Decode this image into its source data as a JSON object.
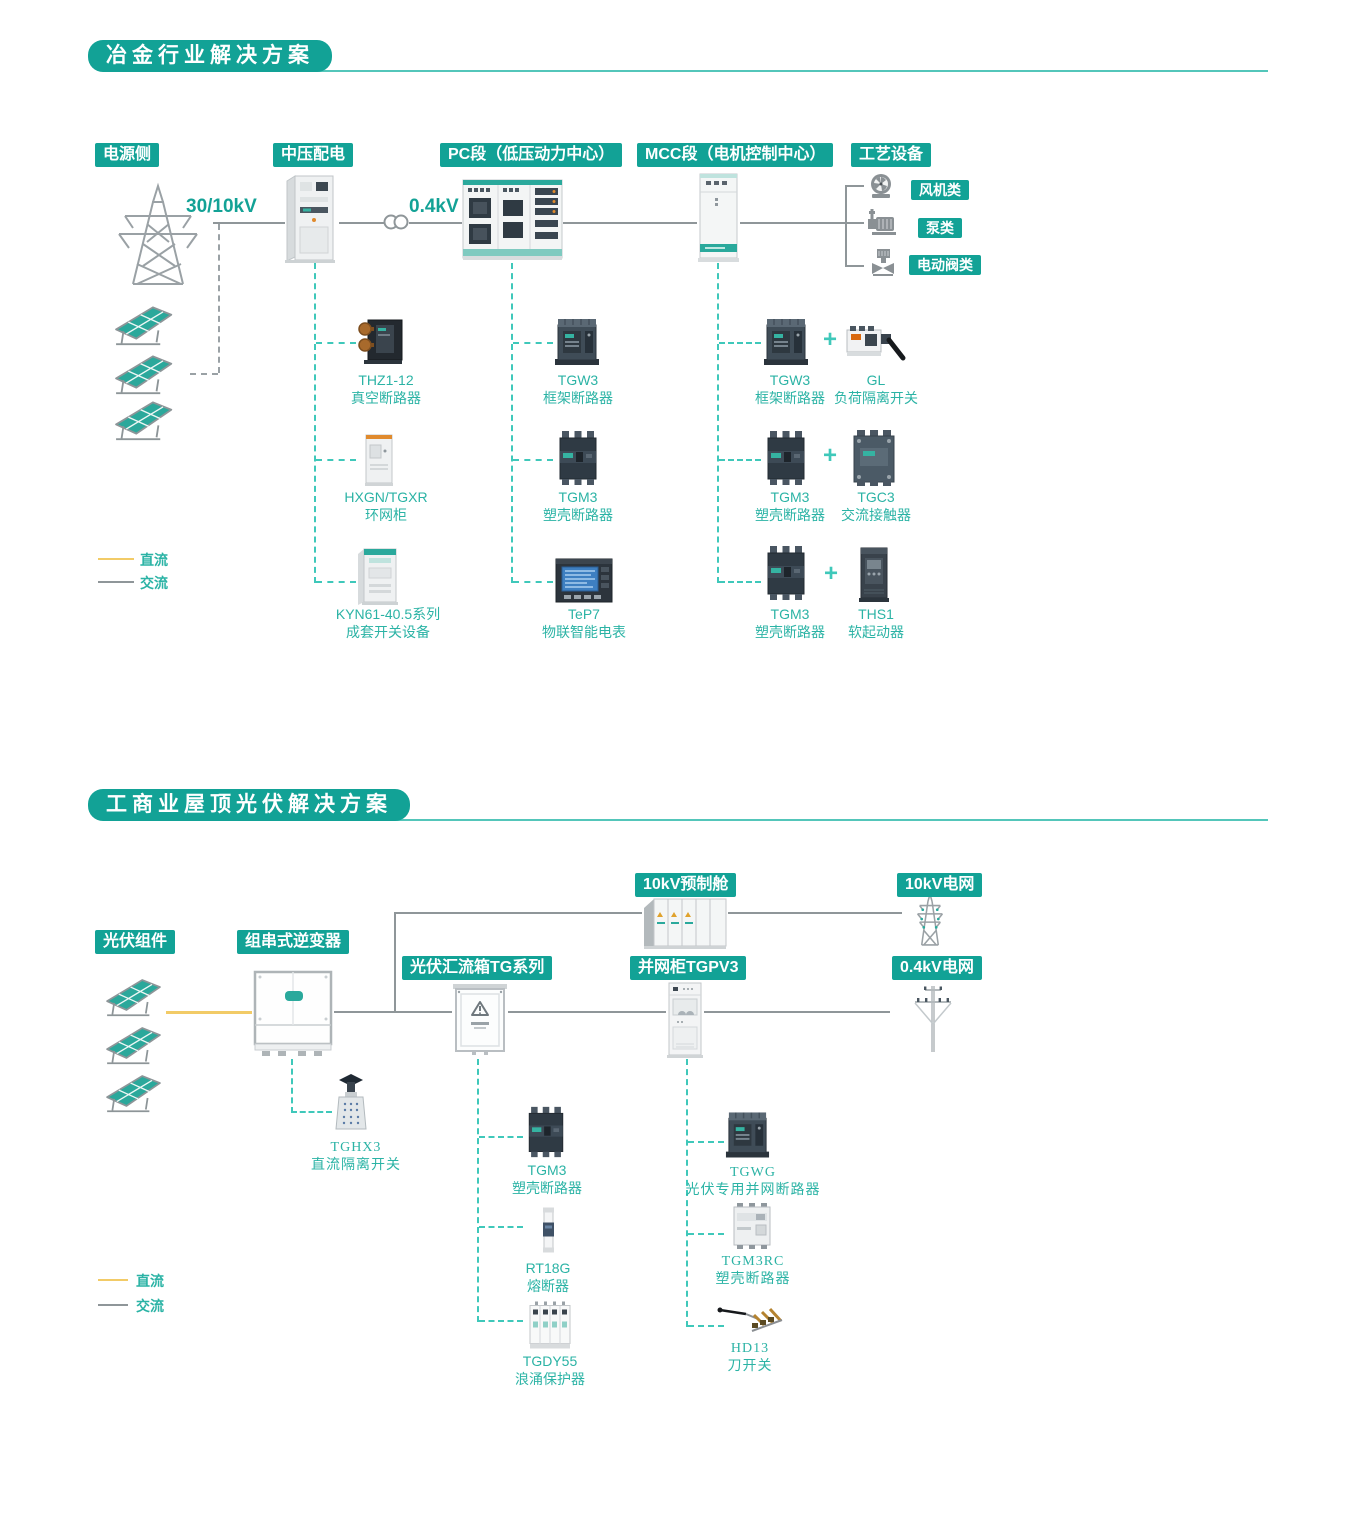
{
  "palette": {
    "accent": "#12a296",
    "label_teal": "#2bb3a5",
    "dc_yellow": "#f2cb67",
    "ac_gray": "#8f9699"
  },
  "s1": {
    "title": "冶金行业解决方案",
    "stages": [
      "电源侧",
      "中压配电",
      "PC段（低压动力中心）",
      "MCC段（电机控制中心）",
      "工艺设备"
    ],
    "voltages": [
      "30/10kV",
      "0.4kV"
    ],
    "loads": [
      "风机类",
      "泵类",
      "电动阀类"
    ],
    "plus": "+",
    "legend": {
      "dc": "直流",
      "ac": "交流"
    },
    "columns": {
      "mv": [
        {
          "model": "THZ1-12",
          "name": "真空断路器"
        },
        {
          "model": "HXGN/TGXR",
          "name": "环网柜"
        },
        {
          "model": "KYN61-40.5系列",
          "name": "成套开关设备"
        }
      ],
      "pc": [
        {
          "model": "TGW3",
          "name": "框架断路器"
        },
        {
          "model": "TGM3",
          "name": "塑壳断路器"
        },
        {
          "model": "TeP7",
          "name": "物联智能电表"
        }
      ],
      "mcc": [
        {
          "left": {
            "model": "TGW3",
            "name": "框架断路器"
          },
          "right": {
            "model": "GL",
            "name": "负荷隔离开关"
          }
        },
        {
          "left": {
            "model": "TGM3",
            "name": "塑壳断路器"
          },
          "right": {
            "model": "TGC3",
            "name": "交流接触器"
          }
        },
        {
          "left": {
            "model": "TGM3",
            "name": "塑壳断路器"
          },
          "right": {
            "model": "THS1",
            "name": "软起动器"
          }
        }
      ]
    }
  },
  "s2": {
    "title": "工商业屋顶光伏解决方案",
    "stages": {
      "pv": "光伏组件",
      "inverter": "组串式逆变器",
      "combiner": "光伏汇流箱TG系列",
      "cabin": "10kV预制舱",
      "grid10": "10kV电网",
      "tgpv": "并网柜TGPV3",
      "grid04": "0.4kV电网"
    },
    "legend": {
      "dc": "直流",
      "ac": "交流"
    },
    "inverter_item": {
      "model": "TGHX3",
      "name": "直流隔离开关"
    },
    "combiner_col": [
      {
        "model": "TGM3",
        "name": "塑壳断路器"
      },
      {
        "model": "RT18G",
        "name": "熔断器"
      },
      {
        "model": "TGDY55",
        "name": "浪涌保护器"
      }
    ],
    "tgpv_col": [
      {
        "model": "TGWG",
        "name": "光伏专用并网断路器"
      },
      {
        "model": "TGM3RC",
        "name": "塑壳断路器"
      },
      {
        "model": "HD13",
        "name": "刀开关"
      }
    ]
  }
}
